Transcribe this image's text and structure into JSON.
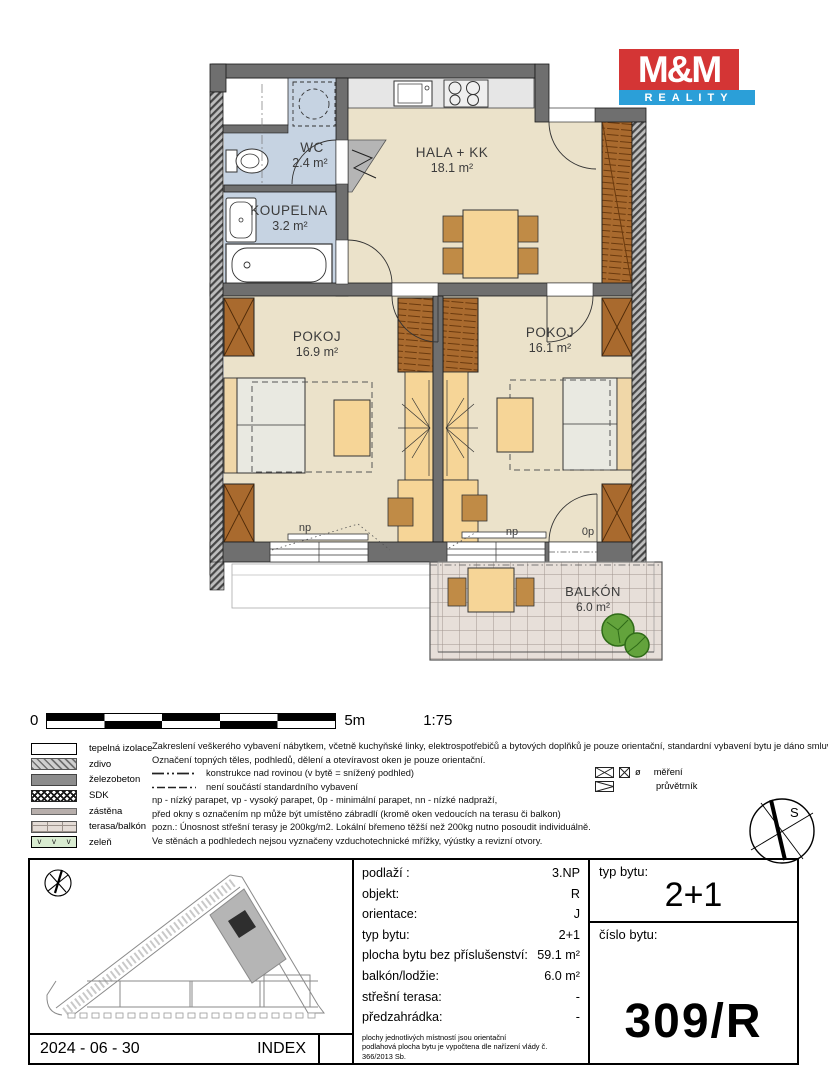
{
  "logo": {
    "line1": "M&M",
    "line2": "REALITY"
  },
  "colors": {
    "logo_red": "#d43535",
    "logo_blue": "#2b9fd8",
    "floor": "#ebe2ca",
    "bath_floor": "#c6d3e2",
    "furniture": "#f6d597",
    "wardrobe": "#a96a2e"
  },
  "plan": {
    "rooms": {
      "wc": {
        "name": "WC",
        "area": "2.4 m²"
      },
      "koupelna": {
        "name": "KOUPELNA",
        "area": "3.2 m²"
      },
      "hala": {
        "name": "HALA + KK",
        "area": "18.1 m²"
      },
      "pokoj1": {
        "name": "POKOJ",
        "area": "16.9 m²"
      },
      "pokoj2": {
        "name": "POKOJ",
        "area": "16.1 m²"
      },
      "balkon": {
        "name": "BALKÓN",
        "area": "6.0 m²"
      }
    },
    "window_labels": {
      "np1": "np",
      "np2": "np",
      "op": "0p"
    }
  },
  "scalebar": {
    "zero": "0",
    "end": "5m",
    "ratio": "1:75"
  },
  "legend": {
    "zelen_marks": "v",
    "items": [
      {
        "label": "tepelná izolace"
      },
      {
        "label": "zdivo"
      },
      {
        "label": "železobeton"
      },
      {
        "label": "SDK"
      },
      {
        "label": "zástěna"
      },
      {
        "label": "terasa/balkón"
      },
      {
        "label": "zeleň"
      }
    ]
  },
  "notes": {
    "lines": [
      "Zakreslení veškerého vybavení nábytkem, včetně kuchyňské linky, elektrospotřebičů a bytových doplňků je pouze orientační, standardní vybavení bytu je dáno smluvními podmínkami.",
      "Označení topných těles, podhledů, dělení a otevíravost oken je pouze orientační.",
      "konstrukce nad rovinou (v bytě = snížený podhled)",
      "není součástí standardního vybavení",
      "np - nízký parapet, vp - vysoký parapet, 0p - minimální parapet, nn - nízké nadpraží,",
      "před okny s označením np může být umístěno zábradlí (kromě oken vedoucích na terasu či balkon)",
      "pozn.: Únosnost střešní terasy je 200kg/m2. Lokální břemeno těžší než 200kg nutno posoudit individuálně.",
      "Ve stěnách a podhledech nejsou vyznačeny vzduchotechnické mřížky, výústky a revizní otvory."
    ]
  },
  "symbols": {
    "mereni": "měření",
    "mereni_glyph": "ø",
    "pruvetrnik": "průvětrník"
  },
  "compass": {
    "label": "S"
  },
  "table": {
    "rows": [
      {
        "label": "podlaží :",
        "value": "3.NP"
      },
      {
        "label": "objekt:",
        "value": "R"
      },
      {
        "label": "orientace:",
        "value": "J"
      },
      {
        "label": "typ bytu:",
        "value": "2+1"
      },
      {
        "label": "plocha bytu bez příslušenství:",
        "value": "59.1 m²"
      },
      {
        "label": "balkón/lodžie:",
        "value": "6.0 m²"
      },
      {
        "label": "střešní terasa:",
        "value": "-"
      },
      {
        "label": "předzahrádka:",
        "value": "-"
      }
    ],
    "footnote1": "plochy jednotlivých místností jsou orientační",
    "footnote2": "podlahová plocha bytu je vypočtena dle nařízení vlády č. 366/2013 Sb."
  },
  "unit": {
    "typ_label": "typ bytu:",
    "typ_value": "2+1",
    "cislo_label": "číslo bytu:",
    "cislo_value": "309/R"
  },
  "footer": {
    "date": "2024 - 06 - 30",
    "index": "INDEX"
  }
}
